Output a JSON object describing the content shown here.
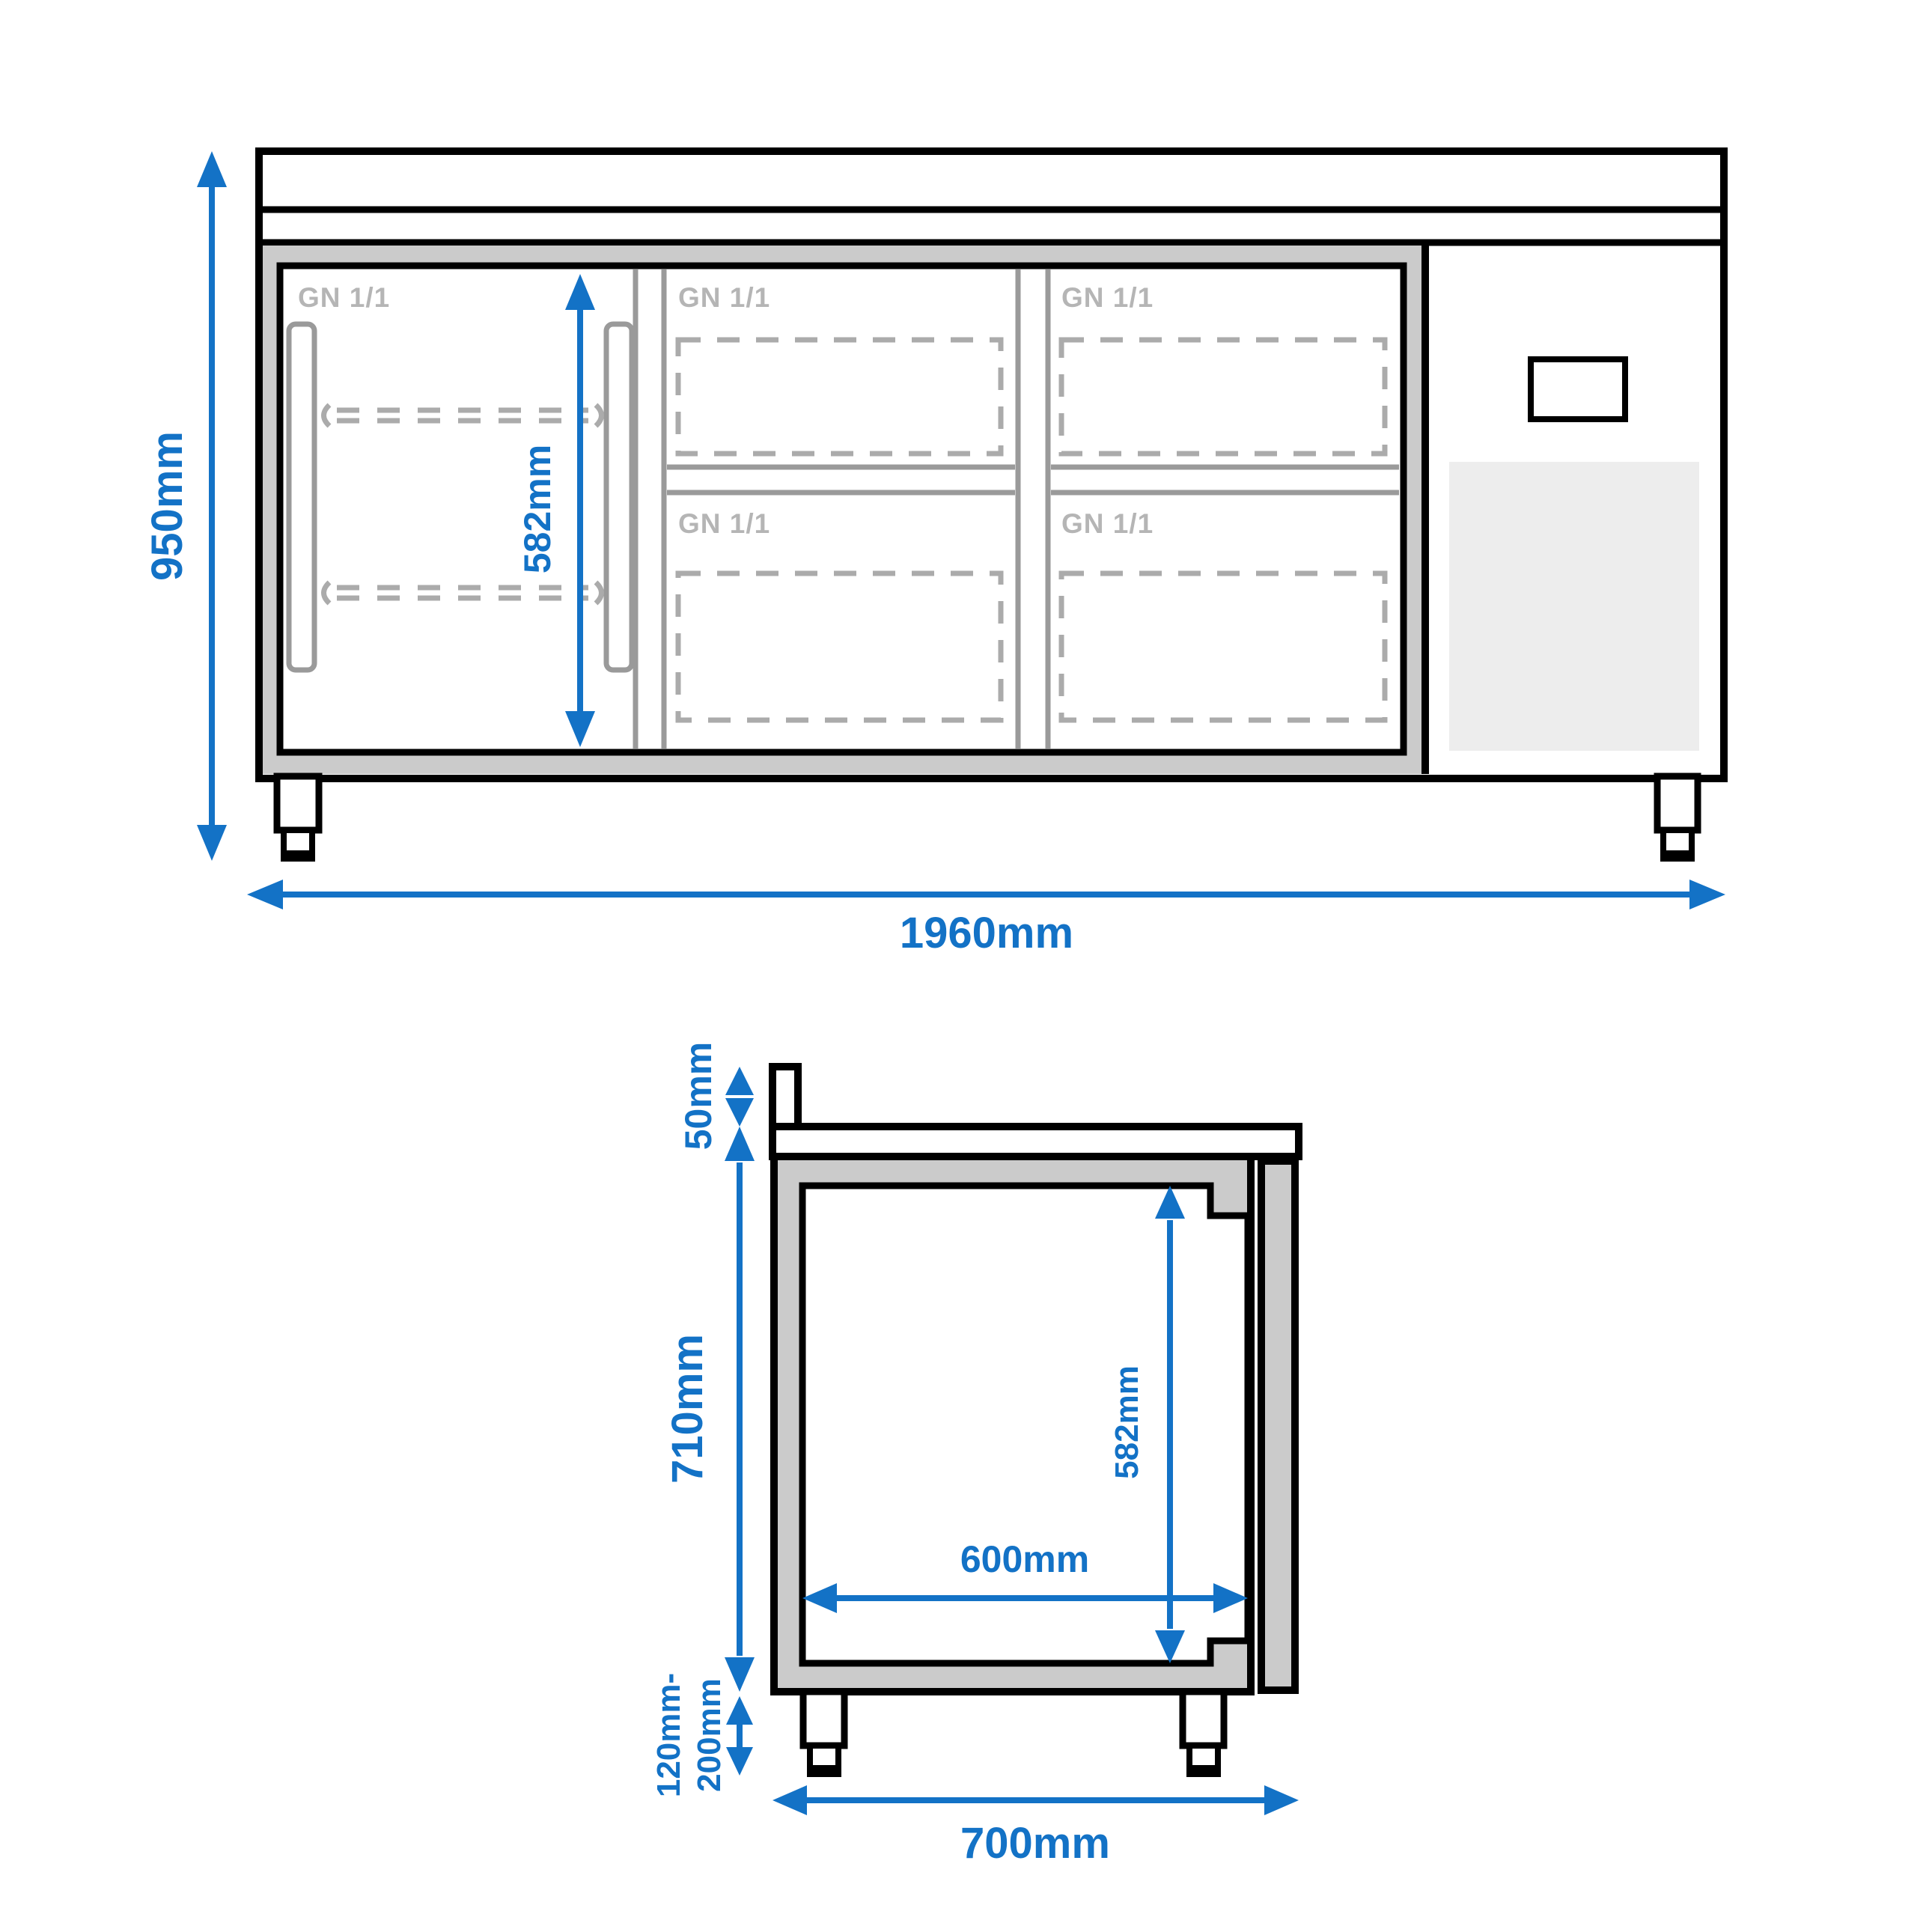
{
  "diagram": {
    "type": "technical dimension drawing",
    "subject": "refrigerated counter with door and GN 1/1 drawers",
    "views": {
      "front": {
        "dimensions": {
          "overall_height": "950mm",
          "overall_width": "1960mm",
          "interior_height": "582mm"
        },
        "gn_labels": {
          "door": "GN 1/1",
          "drawer_col1_top": "GN 1/1",
          "drawer_col1_bottom": "GN 1/1",
          "drawer_col2_top": "GN 1/1",
          "drawer_col2_bottom": "GN 1/1"
        }
      },
      "side": {
        "dimensions": {
          "backsplash_height": "50mm",
          "body_height": "710mm",
          "interior_height": "582mm",
          "interior_depth": "600mm",
          "leg_height_min": "120mm-",
          "leg_height_max": "200mm",
          "overall_depth": "700mm"
        }
      }
    },
    "colors": {
      "dimension_blue": "#1372c6",
      "outline_black": "#000000",
      "frame_gray": "#cbcbcb",
      "detail_line_gray": "#9a9a9a",
      "dashed_gray": "#ababab",
      "gn_label_gray": "#b5b5b5",
      "vent_panel_gray": "#ededed"
    }
  }
}
